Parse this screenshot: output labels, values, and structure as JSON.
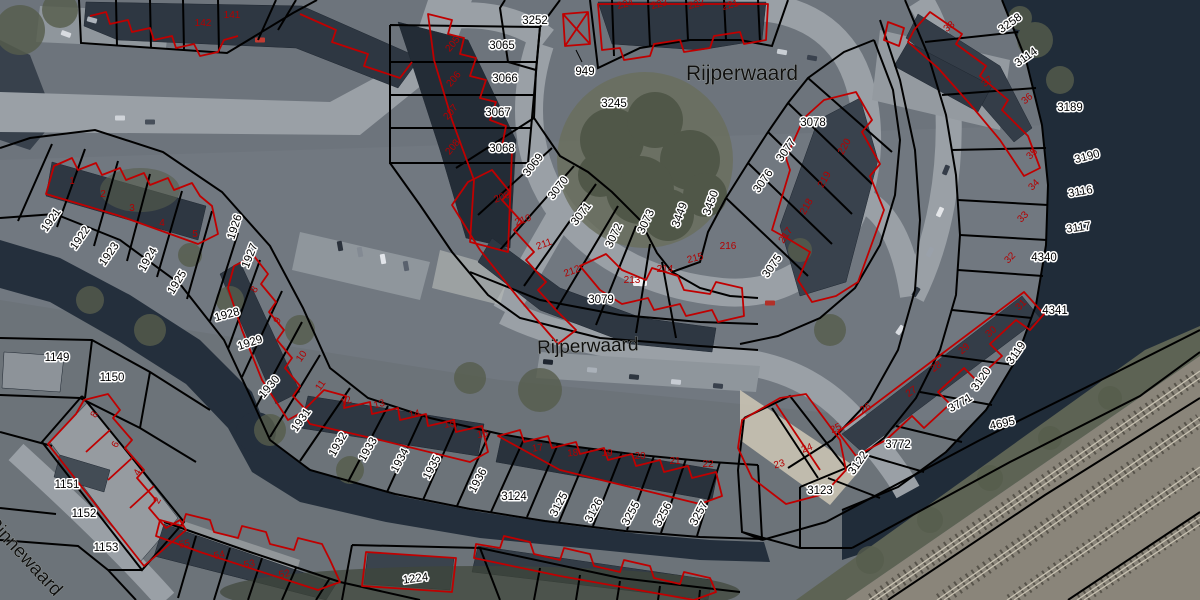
{
  "map": {
    "colors": {
      "parcel_boundary": "#000000",
      "building_outline": "#c00000",
      "parcel_label_text": "#000000",
      "parcel_label_halo": "#ffffff",
      "house_number_text": "#b40000",
      "street_label_text": "#101010",
      "water": "#202c39",
      "road": "#9aa0a6",
      "railway": "#8a857a"
    },
    "street_labels": [
      {
        "t": "Rijperwaard",
        "x": 742,
        "y": 80,
        "r": 0,
        "s": 21
      },
      {
        "t": "Rijperwaard",
        "x": 588,
        "y": 352,
        "r": -2,
        "s": 19
      },
      {
        "t": "Rinnewaard",
        "x": 20,
        "y": 560,
        "r": 47,
        "s": 19,
        "a": "start"
      }
    ],
    "parcel_labels": [
      {
        "t": "3252",
        "x": 535,
        "y": 24
      },
      {
        "t": "3065",
        "x": 502,
        "y": 49
      },
      {
        "t": "3066",
        "x": 505,
        "y": 82
      },
      {
        "t": "3067",
        "x": 498,
        "y": 116
      },
      {
        "t": "3068",
        "x": 502,
        "y": 152
      },
      {
        "t": "949",
        "x": 585,
        "y": 75
      },
      {
        "t": "3245",
        "x": 614,
        "y": 107
      },
      {
        "t": "3069",
        "x": 536,
        "y": 167,
        "r": -52
      },
      {
        "t": "3070",
        "x": 561,
        "y": 190,
        "r": -52
      },
      {
        "t": "3071",
        "x": 584,
        "y": 216,
        "r": -52
      },
      {
        "t": "3072",
        "x": 617,
        "y": 237,
        "r": -65
      },
      {
        "t": "3073",
        "x": 649,
        "y": 223,
        "r": -65
      },
      {
        "t": "3449",
        "x": 683,
        "y": 216,
        "r": -70
      },
      {
        "t": "3450",
        "x": 714,
        "y": 204,
        "r": -70
      },
      {
        "t": "3079",
        "x": 601,
        "y": 303
      },
      {
        "t": "3075",
        "x": 775,
        "y": 268,
        "r": -55
      },
      {
        "t": "3076",
        "x": 766,
        "y": 183,
        "r": -55
      },
      {
        "t": "3077",
        "x": 789,
        "y": 152,
        "r": -55
      },
      {
        "t": "3078",
        "x": 813,
        "y": 126
      },
      {
        "t": "3258",
        "x": 1012,
        "y": 26,
        "r": -35
      },
      {
        "t": "3114",
        "x": 1028,
        "y": 60,
        "r": -35
      },
      {
        "t": "3189",
        "x": 1070,
        "y": 111
      },
      {
        "t": "3190",
        "x": 1088,
        "y": 160,
        "r": -15
      },
      {
        "t": "3116",
        "x": 1081,
        "y": 195,
        "r": -10
      },
      {
        "t": "3117",
        "x": 1079,
        "y": 231,
        "r": -8
      },
      {
        "t": "4340",
        "x": 1044,
        "y": 261
      },
      {
        "t": "4341",
        "x": 1055,
        "y": 314
      },
      {
        "t": "3119",
        "x": 1019,
        "y": 355,
        "r": -55
      },
      {
        "t": "3120",
        "x": 984,
        "y": 381,
        "r": -55
      },
      {
        "t": "3771",
        "x": 962,
        "y": 406,
        "r": -30
      },
      {
        "t": "3772",
        "x": 898,
        "y": 448
      },
      {
        "t": "3122",
        "x": 861,
        "y": 465,
        "r": -55
      },
      {
        "t": "3123",
        "x": 820,
        "y": 494
      },
      {
        "t": "4695",
        "x": 1003,
        "y": 427,
        "r": -12
      },
      {
        "t": "1921",
        "x": 54,
        "y": 222,
        "r": -55
      },
      {
        "t": "1922",
        "x": 83,
        "y": 240,
        "r": -55
      },
      {
        "t": "1923",
        "x": 112,
        "y": 256,
        "r": -55
      },
      {
        "t": "1924",
        "x": 151,
        "y": 261,
        "r": -60
      },
      {
        "t": "1925",
        "x": 180,
        "y": 284,
        "r": -58
      },
      {
        "t": "1926",
        "x": 238,
        "y": 228,
        "r": -72
      },
      {
        "t": "1927",
        "x": 253,
        "y": 257,
        "r": -68
      },
      {
        "t": "1928",
        "x": 228,
        "y": 318,
        "r": -15
      },
      {
        "t": "1929",
        "x": 251,
        "y": 346,
        "r": -18
      },
      {
        "t": "1930",
        "x": 272,
        "y": 389,
        "r": -50
      },
      {
        "t": "1931",
        "x": 304,
        "y": 422,
        "r": -55
      },
      {
        "t": "1932",
        "x": 341,
        "y": 446,
        "r": -60
      },
      {
        "t": "1933",
        "x": 371,
        "y": 451,
        "r": -60
      },
      {
        "t": "1934",
        "x": 403,
        "y": 462,
        "r": -62
      },
      {
        "t": "1935",
        "x": 435,
        "y": 469,
        "r": -62
      },
      {
        "t": "1936",
        "x": 481,
        "y": 482,
        "r": -62
      },
      {
        "t": "3124",
        "x": 514,
        "y": 500
      },
      {
        "t": "3125",
        "x": 562,
        "y": 506,
        "r": -62
      },
      {
        "t": "3126",
        "x": 597,
        "y": 512,
        "r": -62
      },
      {
        "t": "3255",
        "x": 634,
        "y": 515,
        "r": -62
      },
      {
        "t": "3256",
        "x": 666,
        "y": 516,
        "r": -62
      },
      {
        "t": "3257",
        "x": 702,
        "y": 515,
        "r": -62
      },
      {
        "t": "1224",
        "x": 416,
        "y": 582,
        "r": -8
      },
      {
        "t": "1149",
        "x": 57,
        "y": 361
      },
      {
        "t": "1150",
        "x": 112,
        "y": 381
      },
      {
        "t": "1151",
        "x": 67,
        "y": 488
      },
      {
        "t": "1152",
        "x": 84,
        "y": 517
      },
      {
        "t": "1153",
        "x": 106,
        "y": 551
      }
    ],
    "house_numbers": [
      {
        "t": "142",
        "x": 203,
        "y": 26,
        "s": 12
      },
      {
        "t": "141",
        "x": 232,
        "y": 18,
        "s": 12
      },
      {
        "t": "1",
        "x": 72,
        "y": 184
      },
      {
        "t": "2",
        "x": 103,
        "y": 197
      },
      {
        "t": "3",
        "x": 132,
        "y": 211
      },
      {
        "t": "4",
        "x": 162,
        "y": 226
      },
      {
        "t": "5",
        "x": 195,
        "y": 237
      },
      {
        "t": "8",
        "x": 257,
        "y": 291,
        "r": -60
      },
      {
        "t": "9",
        "x": 280,
        "y": 322,
        "r": -60
      },
      {
        "t": "10",
        "x": 304,
        "y": 358,
        "r": -55
      },
      {
        "t": "11",
        "x": 323,
        "y": 387,
        "r": -55
      },
      {
        "t": "12",
        "x": 347,
        "y": 404,
        "r": -20
      },
      {
        "t": "13",
        "x": 380,
        "y": 407,
        "r": -15
      },
      {
        "t": "14",
        "x": 415,
        "y": 417,
        "r": -12
      },
      {
        "t": "15",
        "x": 450,
        "y": 427,
        "r": -10
      },
      {
        "t": "16",
        "x": 483,
        "y": 437,
        "r": -10
      },
      {
        "t": "17",
        "x": 538,
        "y": 451,
        "r": -8
      },
      {
        "t": "18",
        "x": 573,
        "y": 456,
        "r": -5
      },
      {
        "t": "19",
        "x": 607,
        "y": 456
      },
      {
        "t": "20",
        "x": 640,
        "y": 459
      },
      {
        "t": "21",
        "x": 675,
        "y": 464
      },
      {
        "t": "22",
        "x": 708,
        "y": 467
      },
      {
        "t": "23",
        "x": 780,
        "y": 467,
        "r": -15
      },
      {
        "t": "24",
        "x": 808,
        "y": 451,
        "r": -20
      },
      {
        "t": "25",
        "x": 837,
        "y": 431,
        "r": -25
      },
      {
        "t": "26",
        "x": 867,
        "y": 411,
        "r": -30
      },
      {
        "t": "27",
        "x": 913,
        "y": 394,
        "r": -35
      },
      {
        "t": "28",
        "x": 938,
        "y": 369,
        "r": -38
      },
      {
        "t": "29",
        "x": 966,
        "y": 351,
        "r": -40
      },
      {
        "t": "30",
        "x": 993,
        "y": 334,
        "r": -42
      },
      {
        "t": "31",
        "x": 1023,
        "y": 307,
        "r": -45
      },
      {
        "t": "32",
        "x": 1012,
        "y": 260,
        "r": -45
      },
      {
        "t": "33",
        "x": 1025,
        "y": 219,
        "r": -45
      },
      {
        "t": "34",
        "x": 1036,
        "y": 187,
        "r": -45
      },
      {
        "t": "35",
        "x": 1034,
        "y": 156,
        "r": -45
      },
      {
        "t": "36",
        "x": 1029,
        "y": 101,
        "r": -40
      },
      {
        "t": "37",
        "x": 989,
        "y": 84,
        "r": -38
      },
      {
        "t": "38",
        "x": 951,
        "y": 29,
        "r": -38
      },
      {
        "t": "205",
        "x": 455,
        "y": 46,
        "r": -50
      },
      {
        "t": "206",
        "x": 456,
        "y": 81,
        "r": -50
      },
      {
        "t": "207",
        "x": 453,
        "y": 114,
        "r": -50
      },
      {
        "t": "208",
        "x": 455,
        "y": 149,
        "r": -50
      },
      {
        "t": "209",
        "x": 503,
        "y": 200,
        "r": -20
      },
      {
        "t": "210",
        "x": 524,
        "y": 223,
        "r": -20
      },
      {
        "t": "211",
        "x": 545,
        "y": 247,
        "r": -20
      },
      {
        "t": "212",
        "x": 573,
        "y": 274,
        "r": -20
      },
      {
        "t": "213",
        "x": 632,
        "y": 283
      },
      {
        "t": "214",
        "x": 665,
        "y": 272
      },
      {
        "t": "215",
        "x": 696,
        "y": 261,
        "r": -15
      },
      {
        "t": "216",
        "x": 728,
        "y": 249
      },
      {
        "t": "217",
        "x": 788,
        "y": 237,
        "r": -55
      },
      {
        "t": "218",
        "x": 809,
        "y": 208,
        "r": -60
      },
      {
        "t": "219",
        "x": 827,
        "y": 181,
        "r": -60
      },
      {
        "t": "220",
        "x": 847,
        "y": 148,
        "r": -60
      },
      {
        "t": "221",
        "x": 731,
        "y": 8,
        "r": -15
      },
      {
        "t": "222",
        "x": 697,
        "y": 7,
        "r": -15
      },
      {
        "t": "223",
        "x": 660,
        "y": 7,
        "r": -15
      },
      {
        "t": "224",
        "x": 626,
        "y": 7,
        "r": -15
      },
      {
        "t": "8",
        "x": 97,
        "y": 416,
        "r": -60
      },
      {
        "t": "6",
        "x": 118,
        "y": 446,
        "r": -60
      },
      {
        "t": "4",
        "x": 140,
        "y": 474,
        "r": -60
      },
      {
        "t": "2",
        "x": 160,
        "y": 502,
        "r": -60
      },
      {
        "t": "55",
        "x": 185,
        "y": 547,
        "r": -10
      },
      {
        "t": "54",
        "x": 220,
        "y": 558,
        "r": -12
      },
      {
        "t": "53",
        "x": 250,
        "y": 567,
        "r": -12
      },
      {
        "t": "52",
        "x": 285,
        "y": 577,
        "r": -12
      }
    ]
  }
}
